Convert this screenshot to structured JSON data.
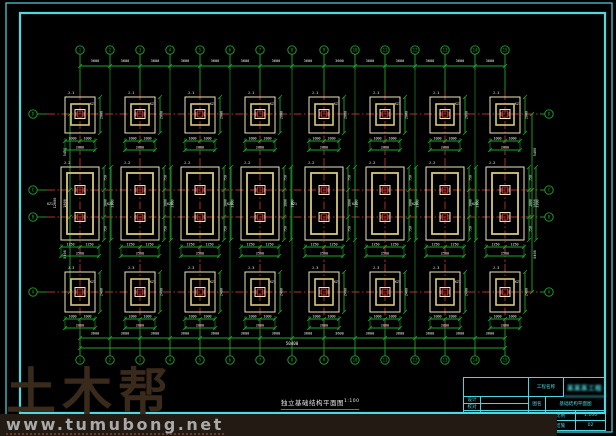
{
  "colors": {
    "bg": "#000000",
    "border_cyan": "#4fd8e0",
    "grid_green": "#1ea62c",
    "center_red": "#b93030",
    "footing_cream": "#ece5bd",
    "footing_khaki": "#d6c97a",
    "dim_white": "#f0f0f0",
    "titleblock_cyan": "#49d6e0",
    "watermark_brown": "#3a2a1c",
    "watermark_gray": "#a9a9a9"
  },
  "grid": {
    "col_labels": [
      "1",
      "2",
      "3",
      "4",
      "5",
      "6",
      "7",
      "8",
      "9",
      "10",
      "11",
      "12",
      "13",
      "14",
      "15"
    ],
    "row_labels": [
      "D",
      "C",
      "B",
      "A"
    ],
    "bay_dims": [
      "3600",
      "3600",
      "3600",
      "3600",
      "3600",
      "3600",
      "3600",
      "3600",
      "3600",
      "3600",
      "3600",
      "3600",
      "3600",
      "3600"
    ],
    "overall_dim": "50400",
    "left_chain_dims": [
      "5400",
      "1800",
      "5400"
    ],
    "left_total_dim": "12600"
  },
  "footings": {
    "row1": {
      "tag": "J-1",
      "split": [
        "1000",
        "1000"
      ],
      "total": "2000",
      "side": "2000",
      "col_tag": "KZ1"
    },
    "row2": {
      "tag": "J-2",
      "split": [
        "1250",
        "1250"
      ],
      "total": "2500",
      "side": "3300",
      "side_parts": [
        "750",
        "1800",
        "750"
      ],
      "col_tag": "KZ1"
    },
    "row3": {
      "tag": "J-3",
      "split": [
        "1000",
        "1000"
      ],
      "total": "2000",
      "side": "2400",
      "col_tag": "KZ1"
    }
  },
  "drawing_title": {
    "text": "独立基础结构平面图",
    "scale": "1:100"
  },
  "title_block": {
    "project_label": "工程名称",
    "project_name": "某某某工程",
    "row_a_label": "设计",
    "row_b_label": "校对",
    "row_c_label": "制图",
    "row_d_label": "审核",
    "mid_label_1": "图名",
    "mid_label_2": "日期",
    "mid_label_3": "图号",
    "drawing_name": "基础结构平面图",
    "scale_label": "比例",
    "scale_value": "1:100",
    "sheet_label": "结施",
    "sheet_value": "02"
  },
  "watermark": {
    "big": "土木帮",
    "url": "www.tumubong.net"
  }
}
